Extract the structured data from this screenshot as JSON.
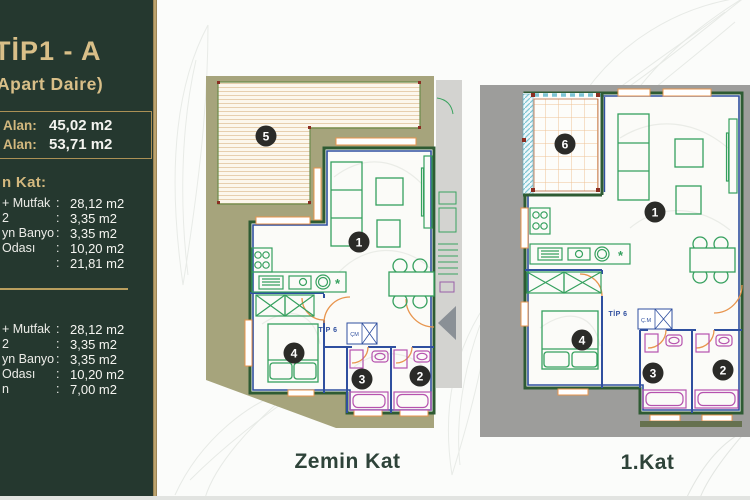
{
  "sidebar": {
    "title": "TİP1 - A",
    "subtitle": "Apart Daire)",
    "area_box": {
      "rows": [
        {
          "label": "Alan:",
          "value": "45,02 m2"
        },
        {
          "label": "Alan:",
          "value": "53,71 m2"
        }
      ]
    },
    "sections": [
      {
        "heading": "n Kat:",
        "rows": [
          {
            "label": "+ Mutfak",
            "value": "28,12 m2"
          },
          {
            "label": "2",
            "value": "3,35 m2"
          },
          {
            "label": "yn Banyo",
            "value": "3,35 m2"
          },
          {
            "label": "Odası",
            "value": "10,20 m2"
          },
          {
            "label": "",
            "value": "21,81 m2"
          }
        ]
      },
      {
        "heading": "",
        "rows": [
          {
            "label": "+ Mutfak",
            "value": "28,12 m2"
          },
          {
            "label": "2",
            "value": "3,35 m2"
          },
          {
            "label": "yn Banyo",
            "value": "3,35 m2"
          },
          {
            "label": "Odası",
            "value": "10,20 m2"
          },
          {
            "label": "n",
            "value": "7,00 m2"
          }
        ]
      }
    ]
  },
  "punct": {
    "colon": ":"
  },
  "plans": [
    {
      "name": "Zemin Kat",
      "unit_label": "TİP 6",
      "closet_label": "ÇM",
      "kitchen_symbol": "*",
      "markers": {
        "living": "1",
        "bath2": "2",
        "bath1": "3",
        "bedroom": "4",
        "terrace": "5"
      }
    },
    {
      "name": "1.Kat",
      "unit_label": "TİP 6",
      "closet_label": "Ç.M",
      "kitchen_symbol": "*",
      "markers": {
        "living": "1",
        "bath2": "2",
        "bath1": "3",
        "bedroom": "4",
        "balcony": "6"
      }
    }
  ],
  "colors": {
    "sidebar_green": "#25382f",
    "gold": "#cdb379",
    "olive": "#a6a47c",
    "plan_gray": "#9d9d9b",
    "wall_blue": "#2f4f9f",
    "wall_dark_green": "#2e5b33",
    "furniture_green": "#35a05e",
    "fixture_magenta": "#b652ae",
    "door_orange": "#e8954e",
    "hatch_cyan": "#7cc4d4",
    "label_green": "#2e4339"
  }
}
